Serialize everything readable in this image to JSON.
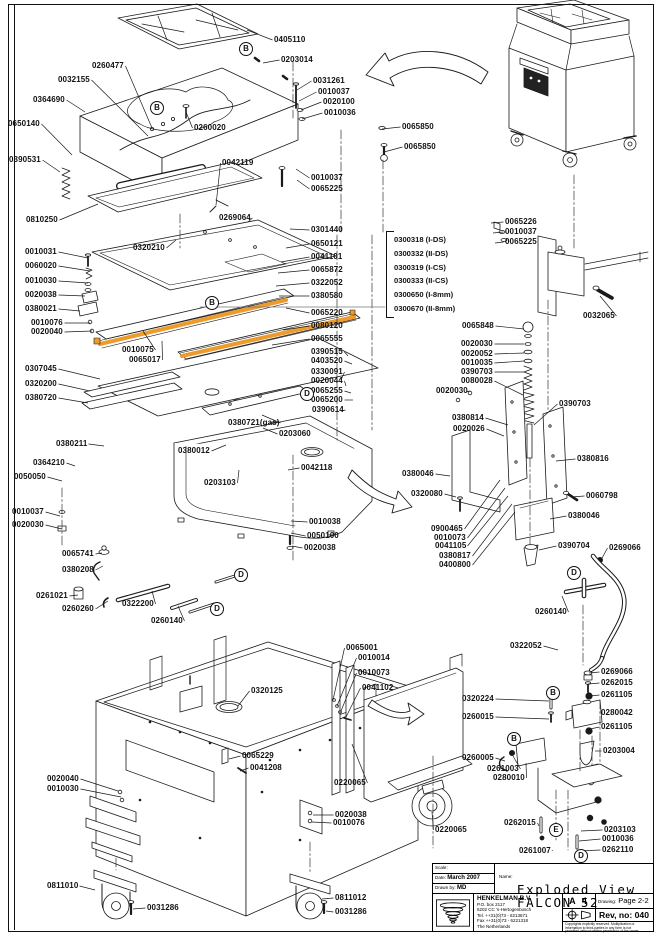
{
  "page": {
    "line_color": "#1a1a1a",
    "seal_bar_color": "#ec9b2c",
    "background": "#ffffff"
  },
  "labels": [
    [
      "0405110",
      274,
      36,
      247,
      30
    ],
    [
      "0203014",
      281,
      56,
      263,
      63
    ],
    [
      "0260477",
      92,
      62,
      152,
      128
    ],
    [
      "0032155",
      58,
      76,
      148,
      136
    ],
    [
      "0364690",
      33,
      96,
      85,
      112
    ],
    [
      "0650140",
      8,
      120,
      72,
      155
    ],
    [
      "0260020",
      194,
      124,
      186,
      112
    ],
    [
      "0390531",
      9,
      156,
      60,
      172
    ],
    [
      "0042119",
      222,
      159,
      216,
      205
    ],
    [
      "0810250",
      26,
      216,
      98,
      204
    ],
    [
      "0269064",
      219,
      214,
      248,
      222
    ],
    [
      "0320210",
      133,
      244,
      176,
      240
    ],
    [
      "0031261",
      313,
      77,
      297,
      90
    ],
    [
      "0010037",
      318,
      88,
      299,
      101
    ],
    [
      "0020100",
      323,
      98,
      301,
      110
    ],
    [
      "0010036",
      324,
      109,
      302,
      119
    ],
    [
      "0065850",
      402,
      123,
      382,
      129
    ],
    [
      "0065850",
      404,
      143,
      384,
      152
    ],
    [
      "0010037",
      311,
      174,
      296,
      169
    ],
    [
      "0065225",
      311,
      185,
      297,
      180
    ],
    [
      "0301440",
      311,
      226,
      290,
      229
    ],
    [
      "0650121",
      311,
      240,
      286,
      248
    ],
    [
      "0041101",
      311,
      253,
      281,
      262
    ],
    [
      "0065872",
      311,
      266,
      278,
      273
    ],
    [
      "0322052",
      311,
      279,
      276,
      286
    ],
    [
      "0380580",
      311,
      292,
      279,
      296
    ],
    [
      "0065220",
      311,
      309,
      286,
      308
    ],
    [
      "0080120",
      311,
      322,
      283,
      330
    ],
    [
      "0065555",
      311,
      335,
      272,
      345
    ],
    [
      "0390515",
      311,
      348,
      348,
      356
    ],
    [
      "0403520",
      311,
      357,
      352,
      364
    ],
    [
      "0330091",
      311,
      368,
      341,
      380
    ],
    [
      "0020044",
      311,
      377,
      346,
      386
    ],
    [
      "0065255",
      311,
      387,
      351,
      393
    ],
    [
      "0065200",
      311,
      396,
      353,
      400
    ],
    [
      "0390614",
      312,
      406,
      341,
      411
    ],
    [
      "0010031",
      25,
      248,
      88,
      258
    ],
    [
      "0060020",
      25,
      262,
      90,
      271
    ],
    [
      "0010030",
      25,
      277,
      88,
      283
    ],
    [
      "0020038",
      25,
      291,
      85,
      296
    ],
    [
      "0380021",
      25,
      305,
      80,
      311
    ],
    [
      "0010076",
      31,
      319,
      90,
      323
    ],
    [
      "0020040",
      31,
      328,
      92,
      331
    ],
    [
      "0010075",
      122,
      346,
      143,
      331
    ],
    [
      "0065017",
      129,
      356,
      162,
      341
    ],
    [
      "0307045",
      25,
      365,
      100,
      379
    ],
    [
      "0320200",
      25,
      380,
      90,
      391
    ],
    [
      "0380720",
      25,
      394,
      88,
      403
    ],
    [
      "0380721(gas)",
      228,
      419,
      262,
      415
    ],
    [
      "0203060",
      279,
      430,
      263,
      428
    ],
    [
      "0380012",
      178,
      447,
      226,
      445
    ],
    [
      "0203103",
      204,
      479,
      239,
      470
    ],
    [
      "0380211",
      56,
      440,
      104,
      446
    ],
    [
      "0364210",
      33,
      459,
      75,
      466
    ],
    [
      "0050050",
      14,
      473,
      62,
      481
    ],
    [
      "0010037",
      12,
      508,
      60,
      516
    ],
    [
      "0020030",
      12,
      521,
      62,
      529
    ],
    [
      "0065741",
      62,
      550,
      102,
      553
    ],
    [
      "0380208",
      62,
      566,
      103,
      566
    ],
    [
      "0261021",
      36,
      592,
      78,
      595
    ],
    [
      "0260260",
      62,
      605,
      108,
      601
    ],
    [
      "0322200",
      122,
      600,
      152,
      591
    ],
    [
      "0260140",
      151,
      617,
      178,
      606
    ],
    [
      "0042118",
      301,
      464,
      288,
      470
    ],
    [
      "0010038",
      309,
      518,
      291,
      521
    ],
    [
      "0050100",
      307,
      532,
      291,
      533
    ],
    [
      "0020038",
      304,
      544,
      292,
      546
    ],
    [
      "0065226",
      505,
      218,
      491,
      223
    ],
    [
      "0010037",
      505,
      228,
      493,
      233
    ],
    [
      "0065225",
      505,
      238,
      495,
      243
    ],
    [
      "0032065",
      583,
      312,
      600,
      296
    ],
    [
      "0065848",
      462,
      322,
      524,
      329
    ],
    [
      "0020030",
      461,
      340,
      524,
      344
    ],
    [
      "0020052",
      461,
      350,
      524,
      353
    ],
    [
      "0010035",
      461,
      359,
      524,
      361
    ],
    [
      "0390703",
      461,
      368,
      524,
      372
    ],
    [
      "0080028",
      461,
      377,
      523,
      395
    ],
    [
      "0020030",
      436,
      387,
      466,
      392
    ],
    [
      "0390703",
      559,
      400,
      534,
      425
    ],
    [
      "0380814",
      452,
      414,
      508,
      425
    ],
    [
      "0020026",
      453,
      425,
      504,
      436
    ],
    [
      "0380816",
      577,
      455,
      556,
      461
    ],
    [
      "0380046",
      402,
      470,
      450,
      476
    ],
    [
      "0320080",
      411,
      490,
      456,
      497
    ],
    [
      "0060798",
      586,
      492,
      571,
      497
    ],
    [
      "0380046",
      568,
      512,
      550,
      519
    ],
    [
      "0900465",
      431,
      525,
      500,
      480
    ],
    [
      "0010073",
      434,
      534,
      505,
      488
    ],
    [
      "0041105",
      435,
      542,
      508,
      496
    ],
    [
      "0380817",
      439,
      552,
      512,
      504
    ],
    [
      "0400800",
      439,
      561,
      515,
      512
    ],
    [
      "0390704",
      558,
      542,
      539,
      550
    ],
    [
      "0269066",
      609,
      544,
      601,
      560
    ],
    [
      "0260140",
      535,
      608,
      562,
      596
    ],
    [
      "0322052",
      510,
      642,
      558,
      650
    ],
    [
      "0269066",
      601,
      668,
      589,
      673
    ],
    [
      "0262015",
      601,
      679,
      588,
      684
    ],
    [
      "0261105",
      601,
      691,
      590,
      696
    ],
    [
      "0280042",
      601,
      709,
      600,
      713
    ],
    [
      "0261105",
      601,
      723,
      590,
      729
    ],
    [
      "0203004",
      603,
      747,
      595,
      751
    ],
    [
      "0320224",
      462,
      695,
      549,
      701
    ],
    [
      "0260015",
      462,
      713,
      549,
      719
    ],
    [
      "0260005",
      462,
      754,
      505,
      761
    ],
    [
      "0261003",
      487,
      765,
      513,
      756
    ],
    [
      "0280010",
      493,
      774,
      526,
      763
    ],
    [
      "0262015",
      504,
      819,
      539,
      826
    ],
    [
      "0261007",
      519,
      847,
      552,
      850
    ],
    [
      "0203103",
      604,
      826,
      581,
      831
    ],
    [
      "0010036",
      602,
      835,
      579,
      841
    ],
    [
      "0262110",
      602,
      846,
      578,
      851
    ],
    [
      "0320125",
      251,
      687,
      238,
      706
    ],
    [
      "0065229",
      242,
      752,
      229,
      759
    ],
    [
      "0041208",
      250,
      764,
      240,
      771
    ],
    [
      "0020040",
      47,
      775,
      118,
      791
    ],
    [
      "0010030",
      47,
      785,
      121,
      797
    ],
    [
      "0811010",
      47,
      882,
      95,
      890
    ],
    [
      "0031286",
      147,
      904,
      133,
      909
    ],
    [
      "0020038",
      335,
      811,
      313,
      815
    ],
    [
      "0010076",
      333,
      819,
      312,
      822
    ],
    [
      "0811012",
      335,
      894,
      322,
      899
    ],
    [
      "0031286",
      335,
      908,
      326,
      911
    ],
    [
      "0065001",
      346,
      644,
      333,
      700
    ],
    [
      "0010014",
      358,
      654,
      337,
      706
    ],
    [
      "0010073",
      358,
      669,
      341,
      711
    ],
    [
      "0041102",
      362,
      684,
      346,
      717
    ],
    [
      "0220065",
      334,
      779,
      352,
      744
    ],
    [
      "0220065",
      435,
      826,
      432,
      812
    ]
  ],
  "callouts": [
    {
      "l": "B",
      "x": 245,
      "y": 48
    },
    {
      "l": "B",
      "x": 156,
      "y": 107
    },
    {
      "l": "B",
      "x": 211,
      "y": 302
    },
    {
      "l": "B",
      "x": 552,
      "y": 692
    },
    {
      "l": "B",
      "x": 513,
      "y": 738
    },
    {
      "l": "D",
      "x": 306,
      "y": 393
    },
    {
      "l": "D",
      "x": 240,
      "y": 574
    },
    {
      "l": "D",
      "x": 216,
      "y": 608
    },
    {
      "l": "D",
      "x": 573,
      "y": 572
    },
    {
      "l": "D",
      "x": 580,
      "y": 855
    },
    {
      "l": "E",
      "x": 555,
      "y": 829
    }
  ],
  "parts_list": {
    "items": [
      "0300318 (I-DS)",
      "0300332 (II-DS)",
      "0300319 (I-CS)",
      "0300333 (II-CS)",
      "0300650 (I-8mm)",
      "0300670 (II-8mm)"
    ]
  },
  "title_block": {
    "scale_label": "Scale:",
    "date_label": "Date:",
    "date_value": "March 2007",
    "drawn_label": "Drawn by:",
    "drawn_value": "MD",
    "name_label": "Name:",
    "name_line1": "Exploded View",
    "name_line2": "FALCON 52",
    "company": "HENKELMAN B.V.",
    "address1": "P.O. box 2117",
    "address2": "5202 CC 's-Hertogenbosch",
    "tel": "Tel. ++31(0)73 - 6213671",
    "fax": "Fax ++31(0)73 - 6221318",
    "country": "The Netherlands",
    "paper_size": "A 4",
    "drawing_label": "Drawing:",
    "drawing_value": "Page 2-2",
    "rev": "Rev, no: 040",
    "fine_print_1": "Copyrights explicitly reserved. Multiplication or",
    "fine_print_2": "information to third-parties in any form is not",
    "fine_print_3": "permitted without written permission of the owner."
  }
}
